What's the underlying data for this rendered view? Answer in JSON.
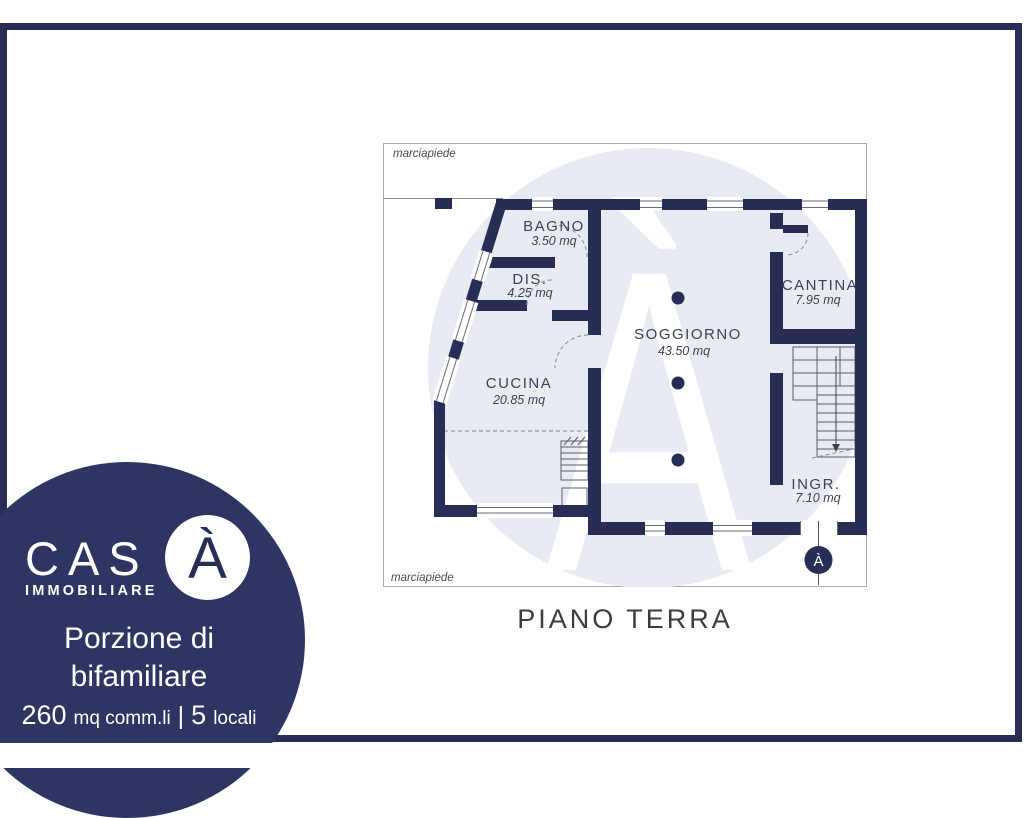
{
  "colors": {
    "navy": "#272d55",
    "blob": "#2f3563",
    "watermark_circle": "#e9ebf2"
  },
  "plan": {
    "sidewalk_top": "marciapiede",
    "sidewalk_bottom": "marciapiede",
    "floor_title": "PIANO TERRA",
    "watermark_letter": "À",
    "entrance_marker_letter": "À",
    "rooms": [
      {
        "name": "BAGNO",
        "area": "3.50 mq"
      },
      {
        "name": "DIS.",
        "area": "4.25 mq"
      },
      {
        "name": "CUCINA",
        "area": "20.85 mq"
      },
      {
        "name": "SOGGIORNO",
        "area": "43.50 mq"
      },
      {
        "name": "CANTINA",
        "area": "7.95 mq"
      },
      {
        "name": "INGR.",
        "area": "7.10 mq"
      }
    ]
  },
  "logo": {
    "brand_text": "CAS",
    "brand_accent": "À",
    "subtitle": "IMMOBILIARE",
    "property_type_line1": "Porzione di",
    "property_type_line2": "bifamiliare",
    "specs": {
      "area_value": "260",
      "area_unit": "mq comm.li",
      "separator": "|",
      "rooms_value": "5",
      "rooms_unit": "locali"
    }
  }
}
